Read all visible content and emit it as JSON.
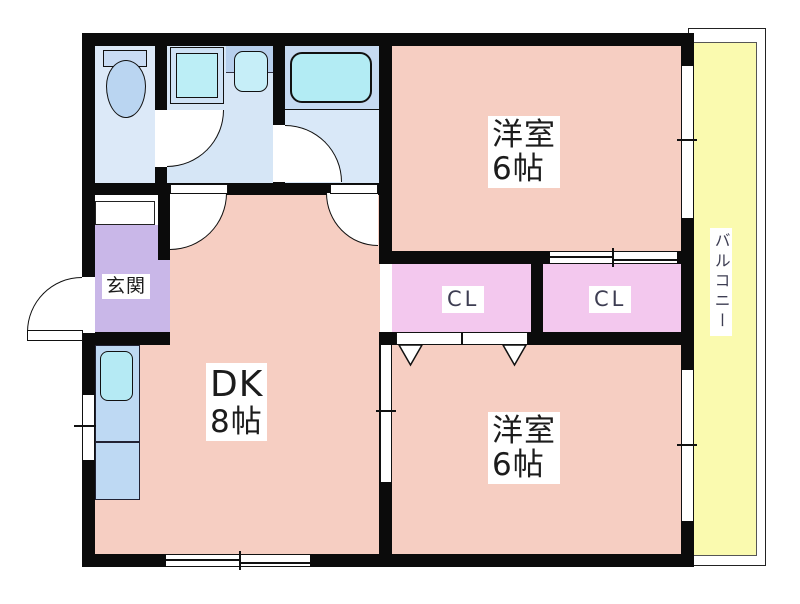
{
  "floor_plan": {
    "rooms": {
      "western_room_top": {
        "name": "洋室",
        "size": "6帖"
      },
      "western_room_bottom": {
        "name": "洋室",
        "size": "6帖"
      },
      "dining_kitchen": {
        "name": "DK",
        "size": "8帖"
      },
      "entrance": {
        "label": "玄関"
      },
      "closet_left": {
        "label": "CL"
      },
      "closet_right": {
        "label": "CL"
      },
      "balcony": {
        "label": "バルコニー"
      }
    },
    "colors": {
      "room_pink": "#f6cec2",
      "closet_pink": "#f3c8ee",
      "entrance_purple": "#c9b7e8",
      "balcony_yellow": "#fafaaf",
      "sanitary_blue": "#d6e6f6",
      "fixture_cyan": "#b5eaf4",
      "wall_black": "#0b0b0b"
    }
  }
}
